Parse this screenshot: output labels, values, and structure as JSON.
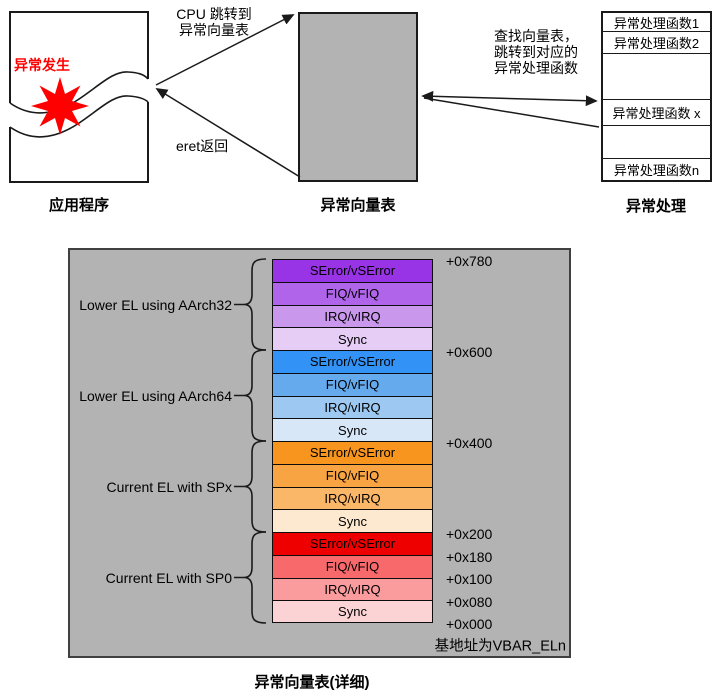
{
  "colors": {
    "panel_gray": "#B3B3B3",
    "exception_red": "#FF0000",
    "line": "#1A1A1A"
  },
  "top": {
    "app": {
      "caption": "应用程序",
      "exception_label": "异常发生"
    },
    "vector": {
      "caption": "异常向量表"
    },
    "handlers": {
      "caption": "异常处理",
      "rows": [
        "异常处理函数1",
        "异常处理函数2",
        "",
        "异常处理函数 x",
        "",
        "异常处理函数n"
      ]
    },
    "labels": {
      "jump1": "CPU 跳转到",
      "jump2": "异常向量表",
      "eret": "eret返回",
      "lookup1": "查找向量表，",
      "lookup2": "跳转到对应的",
      "lookup3": "异常处理函数"
    }
  },
  "detail": {
    "caption": "异常向量表(详细)",
    "base_label": "基地址为VBAR_ELn",
    "offsets": [
      "+0x780",
      "+0x600",
      "+0x400",
      "+0x200",
      "+0x180",
      "+0x100",
      "+0x080",
      "+0x000"
    ],
    "groups": [
      {
        "label": "Lower EL using AArch32",
        "rows": [
          {
            "label": "SError/vSError",
            "color": "#9933E6"
          },
          {
            "label": "FIQ/vFIQ",
            "color": "#B064E9"
          },
          {
            "label": "IRQ/vIRQ",
            "color": "#C998ED"
          },
          {
            "label": "Sync",
            "color": "#E6CDF6"
          }
        ]
      },
      {
        "label": "Lower EL using AArch64",
        "rows": [
          {
            "label": "SError/vSError",
            "color": "#3392F5"
          },
          {
            "label": "FIQ/vFIQ",
            "color": "#66AAEE"
          },
          {
            "label": "IRQ/vIRQ",
            "color": "#9CC8F1"
          },
          {
            "label": "Sync",
            "color": "#D8E7F8"
          }
        ]
      },
      {
        "label": "Current EL with SPx",
        "rows": [
          {
            "label": "SError/vSError",
            "color": "#F7951E"
          },
          {
            "label": "FIQ/vFIQ",
            "color": "#F9A442"
          },
          {
            "label": "IRQ/vIRQ",
            "color": "#FBB768"
          },
          {
            "label": "Sync",
            "color": "#FCE9CF"
          }
        ]
      },
      {
        "label": "Current EL with SP0",
        "rows": [
          {
            "label": "SError/vSError",
            "color": "#EE0000"
          },
          {
            "label": "FIQ/vFIQ",
            "color": "#F8696B"
          },
          {
            "label": "IRQ/vIRQ",
            "color": "#FA9B9D"
          },
          {
            "label": "Sync",
            "color": "#FBD3D5"
          }
        ]
      }
    ]
  }
}
